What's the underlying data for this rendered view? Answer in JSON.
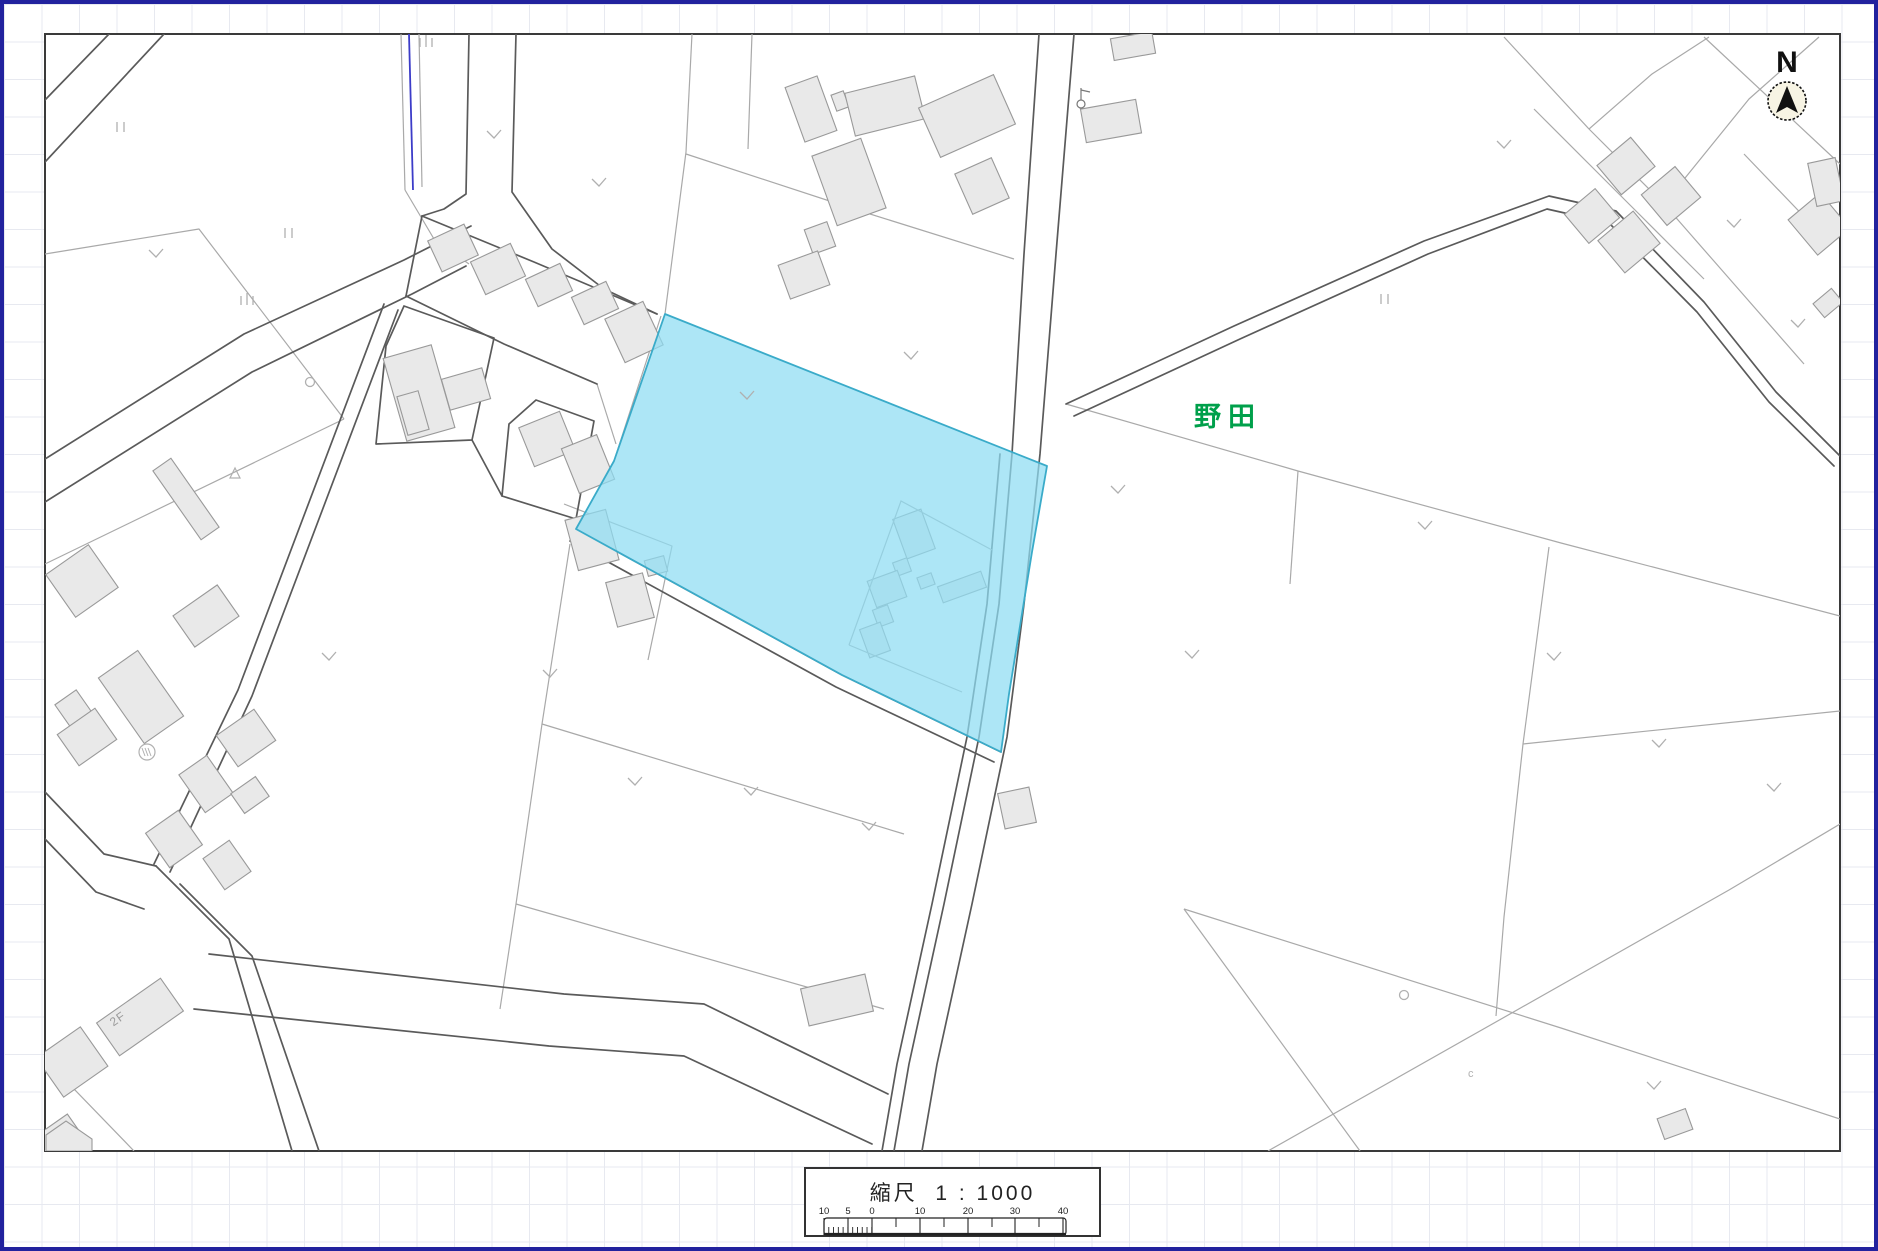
{
  "window": {
    "border_color": "#22229e",
    "grid_color": "#e7e9f0",
    "grid_size": 37.5
  },
  "map": {
    "frame": {
      "x": 41,
      "y": 30,
      "width": 1795,
      "height": 1117,
      "stroke": "#3a3a3a",
      "fill": "#ffffff"
    },
    "colors": {
      "parcel": "#a9a9a9",
      "road": "#5a5a5a",
      "building_fill": "#e9e9e9",
      "building_stroke": "#999999",
      "water": "#3c3cc8",
      "symbol": "#b0b0b0",
      "highlight_fill": "#8edcf2",
      "highlight_stroke": "#3aabc9",
      "highlight_opacity": 0.72
    },
    "labels": [
      {
        "text": "野田",
        "x": 1224,
        "y": 422,
        "size": 27,
        "color": "#00a04b",
        "weight": "bold",
        "spacing": 7,
        "rot": 0
      },
      {
        "text": "2F",
        "x": 116,
        "y": 1018,
        "size": 12,
        "color": "#9a9a9a",
        "weight": "normal",
        "spacing": 1,
        "rot": -35
      }
    ],
    "north_arrow": {
      "label": "N",
      "cx": 1783,
      "cy": 97,
      "r": 19,
      "label_x": 1783,
      "label_y": 68,
      "circle_fill": "#f7f4e4"
    },
    "highlight": {
      "points": "661,310 1043,462 1028,548 1005,690 997,748 838,671 572,525 610,457"
    },
    "highlight_inner_lines": [
      {
        "p": "845,641 897,497 988,546"
      },
      {
        "p": "845,641 958,688"
      }
    ],
    "highlight_buildings": [
      {
        "cx": 910,
        "cy": 530,
        "w": 30,
        "h": 42,
        "r": -20
      },
      {
        "cx": 898,
        "cy": 563,
        "w": 15,
        "h": 14,
        "r": -20
      },
      {
        "cx": 883,
        "cy": 585,
        "w": 32,
        "h": 28,
        "r": -20
      },
      {
        "cx": 879,
        "cy": 612,
        "w": 16,
        "h": 18,
        "r": -20
      },
      {
        "cx": 871,
        "cy": 636,
        "w": 22,
        "h": 30,
        "r": -20
      },
      {
        "cx": 922,
        "cy": 577,
        "w": 15,
        "h": 12,
        "r": -20
      },
      {
        "cx": 958,
        "cy": 583,
        "w": 46,
        "h": 17,
        "r": -20
      }
    ],
    "roads": [
      {
        "p": "1035,30 1020,250 1008,450 995,600 975,733 940,900 905,1060 890,1147"
      },
      {
        "p": "996,450 983,600 963,733 928,900 893,1060 878,1147"
      },
      {
        "p": "1070,30 1052,250 1036,450 1020,600 1003,733 968,900 933,1060 918,1147"
      },
      {
        "p": "1062,400 1230,322 1420,237 1545,192 1612,207 1700,298 1772,388 1836,452"
      },
      {
        "p": "1070,412 1236,335 1424,250 1543,205 1605,219 1693,308 1765,398 1830,462"
      },
      {
        "p": "380,300 234,686 150,860"
      },
      {
        "p": "394,306 248,692 166,868"
      },
      {
        "p": "41,788 100,850 152,862"
      },
      {
        "p": "41,835 92,888 140,905"
      },
      {
        "p": "152,862 225,935 288,1147"
      },
      {
        "p": "176,880 248,952 315,1147"
      },
      {
        "p": "205,950 560,990 700,1000 884,1090"
      },
      {
        "p": "190,1005 545,1042 680,1052 868,1140"
      },
      {
        "p": "465,30 462,190 440,205 418,212"
      },
      {
        "p": "512,30 508,188 548,245 600,285 653,310"
      },
      {
        "p": "418,212 530,258 653,310"
      },
      {
        "p": "402,292 500,340 593,380"
      },
      {
        "p": "418,212 402,292"
      },
      {
        "p": "400,302 490,334 468,436 372,440 382,342 400,302"
      },
      {
        "p": "505,420 532,396 590,417 572,515 498,492 505,420"
      },
      {
        "p": "468,436 498,492"
      },
      {
        "p": "572,525 838,671 997,748"
      },
      {
        "p": "566,537 832,683 990,758"
      },
      {
        "p": "41,455 240,330 400,256 467,222"
      },
      {
        "p": "41,498 248,368 408,290 462,262"
      },
      {
        "p": "105,30 41,96"
      },
      {
        "p": "160,30 41,158"
      }
    ],
    "parcels": [
      {
        "p": "41,250 195,225 340,415"
      },
      {
        "p": "340,415 41,560"
      },
      {
        "p": "657,312 610,457 572,525"
      },
      {
        "p": "661,310 682,148 688,30"
      },
      {
        "p": "682,150 850,205 1010,255"
      },
      {
        "p": "748,30 744,145"
      },
      {
        "p": "1062,400 1294,467 1557,539 1836,612"
      },
      {
        "p": "1545,543 1519,740 1500,913 1492,1012"
      },
      {
        "p": "1519,740 1836,707"
      },
      {
        "p": "1294,467 1286,580"
      },
      {
        "p": "1180,905 1356,1147"
      },
      {
        "p": "1180,905 1557,1024 1836,1115"
      },
      {
        "p": "1264,1147 1725,886 1836,820"
      },
      {
        "p": "1500,33 1585,125 1660,200"
      },
      {
        "p": "1585,125 1648,70 1705,33"
      },
      {
        "p": "1700,33 1836,160"
      },
      {
        "p": "1815,33 1745,95 1660,200"
      },
      {
        "p": "1660,200 1730,280 1800,360"
      },
      {
        "p": "1530,105 1625,200 1700,275"
      },
      {
        "p": "1740,150 1812,225"
      },
      {
        "p": "397,30 401,186"
      },
      {
        "p": "415,30 418,183"
      },
      {
        "p": "401,186 430,235 465,260"
      },
      {
        "p": "566,540 538,720 512,900 496,1005"
      },
      {
        "p": "538,720 900,830"
      },
      {
        "p": "512,900 880,1005"
      },
      {
        "p": "560,500 668,542 644,656"
      },
      {
        "p": "41,1055 130,1147"
      },
      {
        "p": "593,380 612,440"
      }
    ],
    "water": [
      {
        "p": "405,30 409,186"
      }
    ],
    "buildings": [
      {
        "cx": 807,
        "cy": 105,
        "w": 34,
        "h": 58,
        "r": -20
      },
      {
        "cx": 836,
        "cy": 97,
        "w": 13,
        "h": 17,
        "r": -20
      },
      {
        "cx": 881,
        "cy": 102,
        "w": 72,
        "h": 44,
        "r": -14
      },
      {
        "cx": 963,
        "cy": 112,
        "w": 82,
        "h": 54,
        "r": -24
      },
      {
        "cx": 978,
        "cy": 182,
        "w": 40,
        "h": 44,
        "r": -24
      },
      {
        "cx": 845,
        "cy": 178,
        "w": 52,
        "h": 74,
        "r": -20
      },
      {
        "cx": 816,
        "cy": 234,
        "w": 24,
        "h": 26,
        "r": -20
      },
      {
        "cx": 800,
        "cy": 271,
        "w": 42,
        "h": 36,
        "r": -20
      },
      {
        "cx": 449,
        "cy": 244,
        "w": 40,
        "h": 34,
        "r": -25
      },
      {
        "cx": 494,
        "cy": 265,
        "w": 44,
        "h": 36,
        "r": -25
      },
      {
        "cx": 545,
        "cy": 281,
        "w": 38,
        "h": 30,
        "r": -25
      },
      {
        "cx": 591,
        "cy": 299,
        "w": 38,
        "h": 30,
        "r": -25
      },
      {
        "cx": 630,
        "cy": 328,
        "w": 42,
        "h": 48,
        "r": -25
      },
      {
        "cx": 415,
        "cy": 389,
        "w": 50,
        "h": 86,
        "r": -16
      },
      {
        "cx": 462,
        "cy": 385,
        "w": 42,
        "h": 32,
        "r": -16
      },
      {
        "cx": 409,
        "cy": 409,
        "w": 22,
        "h": 40,
        "r": -16
      },
      {
        "cx": 543,
        "cy": 435,
        "w": 44,
        "h": 42,
        "r": -22
      },
      {
        "cx": 584,
        "cy": 460,
        "w": 38,
        "h": 48,
        "r": -22
      },
      {
        "cx": 182,
        "cy": 495,
        "w": 22,
        "h": 84,
        "r": -35
      },
      {
        "cx": 78,
        "cy": 577,
        "w": 52,
        "h": 52,
        "r": -35
      },
      {
        "cx": 202,
        "cy": 612,
        "w": 54,
        "h": 38,
        "r": -35
      },
      {
        "cx": 137,
        "cy": 693,
        "w": 48,
        "h": 80,
        "r": -35
      },
      {
        "cx": 69,
        "cy": 704,
        "w": 26,
        "h": 26,
        "r": -35
      },
      {
        "cx": 83,
        "cy": 733,
        "w": 46,
        "h": 38,
        "r": -35
      },
      {
        "cx": 242,
        "cy": 734,
        "w": 46,
        "h": 38,
        "r": -35
      },
      {
        "cx": 202,
        "cy": 780,
        "w": 34,
        "h": 46,
        "r": -35
      },
      {
        "cx": 246,
        "cy": 791,
        "w": 30,
        "h": 24,
        "r": -35
      },
      {
        "cx": 170,
        "cy": 835,
        "w": 40,
        "h": 42,
        "r": -35
      },
      {
        "cx": 223,
        "cy": 861,
        "w": 32,
        "h": 38,
        "r": -35
      },
      {
        "cx": 588,
        "cy": 536,
        "w": 42,
        "h": 52,
        "r": -15
      },
      {
        "cx": 626,
        "cy": 596,
        "w": 38,
        "h": 46,
        "r": -15
      },
      {
        "cx": 652,
        "cy": 562,
        "w": 20,
        "h": 16,
        "r": -15
      },
      {
        "cx": 833,
        "cy": 996,
        "w": 66,
        "h": 38,
        "r": -13
      },
      {
        "cx": 1013,
        "cy": 804,
        "w": 32,
        "h": 36,
        "r": -12
      },
      {
        "cx": 1107,
        "cy": 117,
        "w": 56,
        "h": 34,
        "r": -10
      },
      {
        "cx": 1129,
        "cy": 42,
        "w": 42,
        "h": 22,
        "r": -10
      },
      {
        "cx": 1622,
        "cy": 162,
        "w": 44,
        "h": 38,
        "r": -40
      },
      {
        "cx": 1667,
        "cy": 192,
        "w": 44,
        "h": 40,
        "r": -40
      },
      {
        "cx": 1588,
        "cy": 212,
        "w": 40,
        "h": 38,
        "r": -40
      },
      {
        "cx": 1625,
        "cy": 238,
        "w": 46,
        "h": 42,
        "r": -40
      },
      {
        "cx": 1815,
        "cy": 220,
        "w": 42,
        "h": 46,
        "r": -40
      },
      {
        "cx": 1824,
        "cy": 299,
        "w": 24,
        "h": 18,
        "r": -40
      },
      {
        "cx": 1822,
        "cy": 178,
        "w": 28,
        "h": 44,
        "r": -12
      },
      {
        "cx": 136,
        "cy": 1013,
        "w": 78,
        "h": 40,
        "r": -35
      },
      {
        "cx": 68,
        "cy": 1058,
        "w": 54,
        "h": 48,
        "r": -35
      },
      {
        "cx": 55,
        "cy": 1133,
        "w": 40,
        "h": 28,
        "r": -35
      },
      {
        "cx": 1671,
        "cy": 1120,
        "w": 30,
        "h": 22,
        "r": -20
      }
    ],
    "building_polygons": [
      {
        "points": "42,1131 62,1117 88,1135 88,1147 42,1147"
      }
    ],
    "symbols": [
      {
        "t": "v",
        "x": 595,
        "y": 182
      },
      {
        "t": "v",
        "x": 907,
        "y": 355
      },
      {
        "t": "v",
        "x": 1114,
        "y": 489
      },
      {
        "t": "v",
        "x": 1188,
        "y": 654
      },
      {
        "t": "v",
        "x": 743,
        "y": 395
      },
      {
        "t": "v",
        "x": 1421,
        "y": 525
      },
      {
        "t": "v",
        "x": 1550,
        "y": 656
      },
      {
        "t": "v",
        "x": 1655,
        "y": 743
      },
      {
        "t": "v",
        "x": 1770,
        "y": 787
      },
      {
        "t": "v",
        "x": 325,
        "y": 656
      },
      {
        "t": "v",
        "x": 546,
        "y": 673
      },
      {
        "t": "v",
        "x": 631,
        "y": 781
      },
      {
        "t": "v",
        "x": 747,
        "y": 791
      },
      {
        "t": "v",
        "x": 865,
        "y": 826
      },
      {
        "t": "v",
        "x": 152,
        "y": 253
      },
      {
        "t": "v",
        "x": 490,
        "y": 134
      },
      {
        "t": "v",
        "x": 1500,
        "y": 144
      },
      {
        "t": "v",
        "x": 1730,
        "y": 223
      },
      {
        "t": "v",
        "x": 1794,
        "y": 323
      },
      {
        "t": "v",
        "x": 1650,
        "y": 1085
      },
      {
        "t": "ii",
        "x": 116,
        "y": 123
      },
      {
        "t": "ii",
        "x": 284,
        "y": 229
      },
      {
        "t": "ii",
        "x": 1380,
        "y": 295
      },
      {
        "t": "iii",
        "x": 422,
        "y": 38
      },
      {
        "t": "iii",
        "x": 243,
        "y": 296
      },
      {
        "t": "o",
        "x": 306,
        "y": 378
      },
      {
        "t": "o",
        "x": 1400,
        "y": 991
      },
      {
        "t": "circled",
        "x": 143,
        "y": 748
      },
      {
        "t": "tri",
        "x": 231,
        "y": 470
      },
      {
        "t": "c",
        "x": 1464,
        "y": 1073
      },
      {
        "t": "pole",
        "x": 1077,
        "y": 100
      }
    ]
  },
  "scale_bar": {
    "title": "縮尺  1 : 1000",
    "box": {
      "x": 800,
      "y": 1163,
      "width": 297,
      "height": 70
    },
    "ruler": {
      "x0": 818,
      "x1": 1060,
      "top": 49,
      "bottom": 66,
      "label_y": 45,
      "zero": 866,
      "unit_px": 4.78,
      "fine_end": 866,
      "mid_ticks": [
        842,
        890,
        938,
        986,
        1033
      ],
      "labels": [
        {
          "t": "10",
          "x": 818
        },
        {
          "t": "5",
          "x": 842
        },
        {
          "t": "0",
          "x": 866
        },
        {
          "t": "10",
          "x": 914
        },
        {
          "t": "20",
          "x": 962
        },
        {
          "t": "30",
          "x": 1009
        },
        {
          "t": "40",
          "x": 1057
        }
      ]
    }
  }
}
